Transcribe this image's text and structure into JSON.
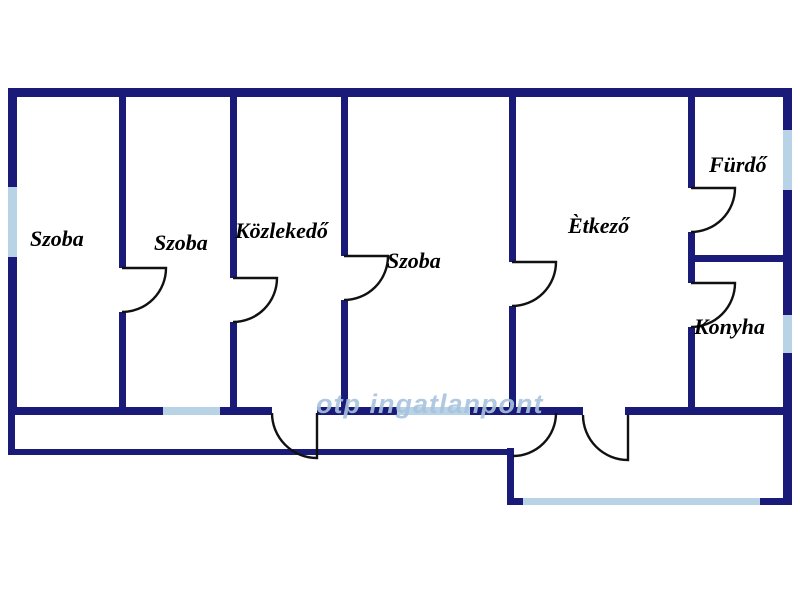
{
  "floorplan": {
    "title": "apartment-floor-plan",
    "rooms": [
      {
        "id": "szoba-1",
        "label": "Szoba"
      },
      {
        "id": "szoba-2",
        "label": "Szoba"
      },
      {
        "id": "kozlekedo",
        "label": "Közlekedő"
      },
      {
        "id": "szoba-3",
        "label": "Szoba"
      },
      {
        "id": "etkezo",
        "label": "Ètkező"
      },
      {
        "id": "furdo",
        "label": "Fürdő"
      },
      {
        "id": "konyha",
        "label": "Konyha"
      }
    ],
    "watermark": "otp ingatlanpont",
    "counts": {
      "doors": 9,
      "windows": 6
    },
    "colors": {
      "wall": "#1a1a78",
      "window": "#b8d2e6",
      "door_line": "#111111",
      "background": "#ffffff",
      "watermark": "#a8c4de"
    }
  }
}
